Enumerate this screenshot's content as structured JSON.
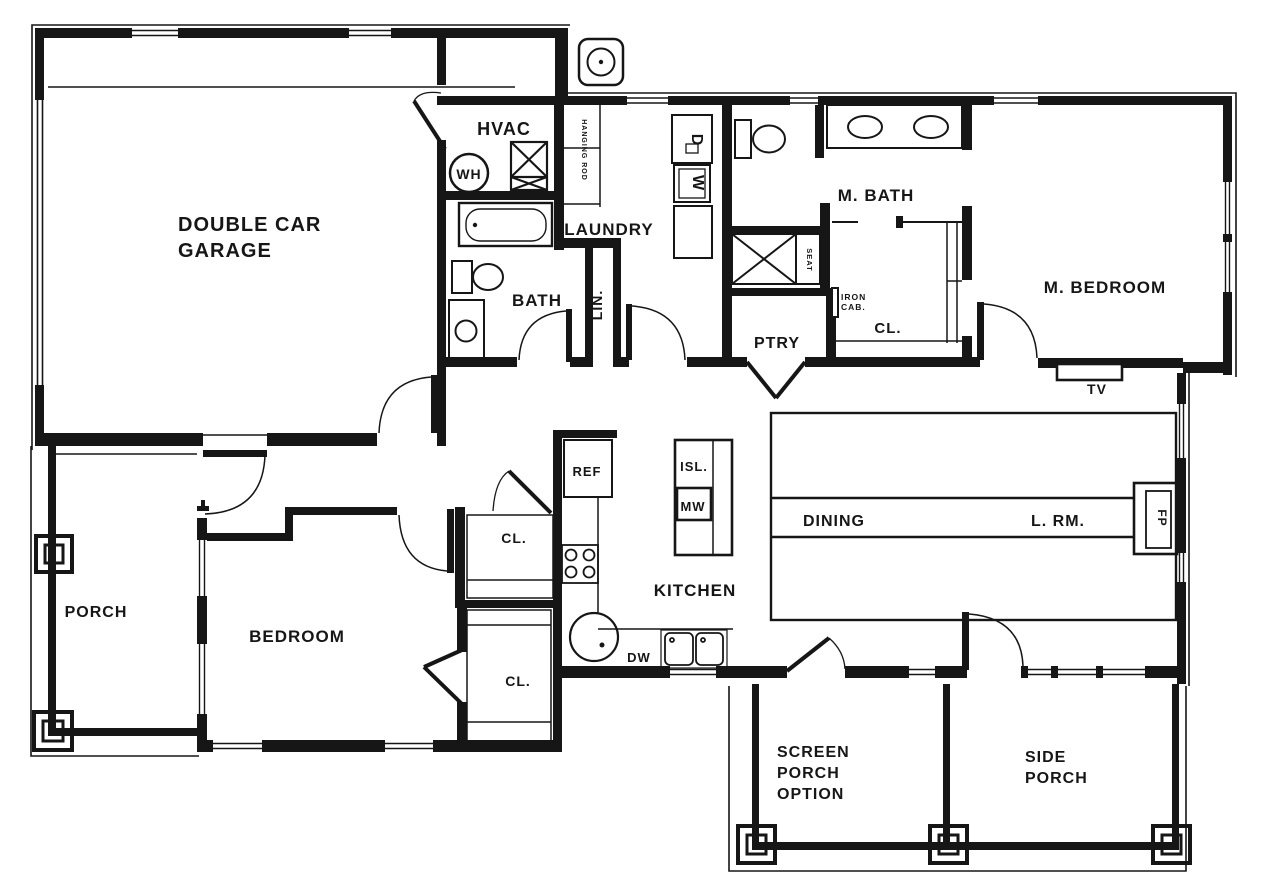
{
  "meta": {
    "drawing_type": "residential single-story floor plan, black line work on white",
    "ink_color": "#161616",
    "paper_color": "#ffffff"
  },
  "labels": {
    "garage_line1": "DOUBLE CAR",
    "garage_line2": "GARAGE",
    "hvac": "HVAC",
    "water_heater": "WH",
    "laundry": "LAUNDRY",
    "hanging_rod": "HANGING ROD",
    "dryer": "D",
    "washer": "W",
    "bath": "BATH",
    "linen": "LIN.",
    "master_bath": "M. BATH",
    "shower_seat": "SEAT",
    "iron_cab_line1": "IRON",
    "iron_cab_line2": "CAB.",
    "master_closet": "CL.",
    "master_bedroom": "M. BEDROOM",
    "tv": "TV",
    "pantry": "PTRY",
    "refrigerator": "REF",
    "island": "ISL.",
    "microwave": "MW",
    "kitchen": "KITCHEN",
    "dishwasher": "DW",
    "dining": "DINING",
    "living_room": "L. RM.",
    "fireplace": "FP",
    "porch": "PORCH",
    "bedroom": "BEDROOM",
    "closet_hall": "CL.",
    "closet_bedroom": "CL.",
    "screen_porch_line1": "SCREEN",
    "screen_porch_line2": "PORCH",
    "screen_porch_line3": "OPTION",
    "side_porch_line1": "SIDE",
    "side_porch_line2": "PORCH"
  }
}
